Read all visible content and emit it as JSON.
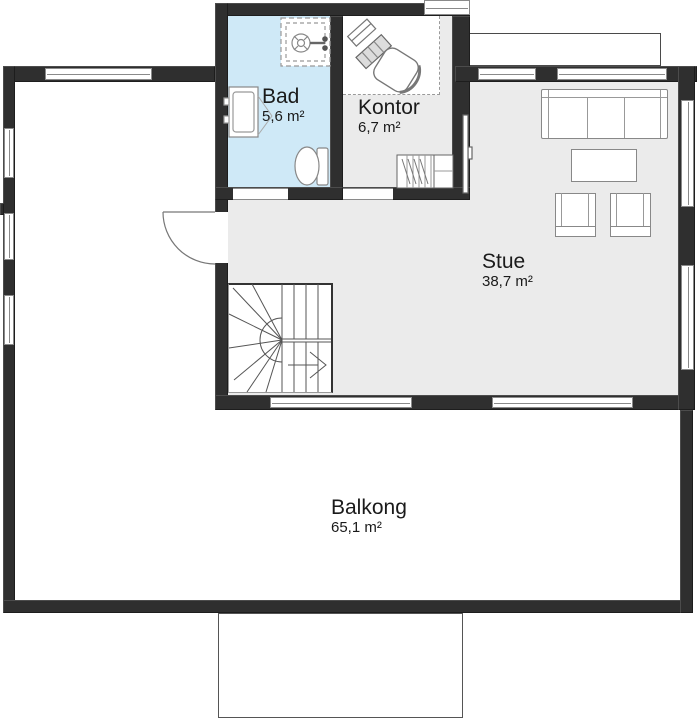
{
  "rooms": {
    "bad": {
      "label": "Bad",
      "area": "5,6 m²"
    },
    "kontor": {
      "label": "Kontor",
      "area": "6,7 m²"
    },
    "stue": {
      "label": "Stue",
      "area": "38,7 m²"
    },
    "balkong": {
      "label": "Balkong",
      "area": "65,1 m²"
    }
  },
  "fixtures": {
    "bad": [
      "shower-icon",
      "sink-icon",
      "toilet-icon"
    ],
    "kontor": [
      "desk-icon",
      "office-chair-icon",
      "wardrobe-icon"
    ],
    "stue": [
      "sofa-icon",
      "coffee-table-icon",
      "armchair-icon",
      "armchair-icon",
      "tv-icon"
    ],
    "circulation": [
      "winder-staircase-icon",
      "balcony-door-icon",
      "direction-arrow-icon"
    ]
  },
  "colors": {
    "wall": "#2f2f2f",
    "floor": "#ebebeb",
    "bad_floor": "#cfe9f7",
    "line": "#8a8a8a",
    "outline": "#4a4a4a",
    "text": "#1a1a1a",
    "white": "#ffffff"
  }
}
